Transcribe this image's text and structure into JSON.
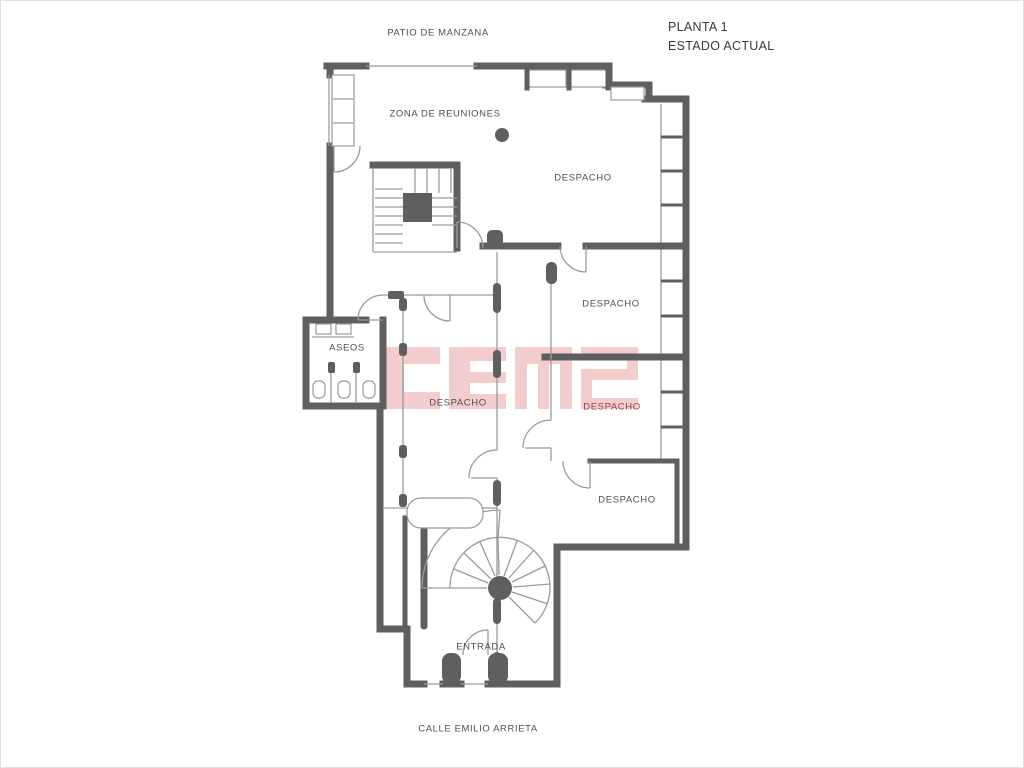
{
  "title": {
    "line1": "PLANTA 1",
    "line2": "ESTADO ACTUAL"
  },
  "context": {
    "top_street": "PATIO DE MANZANA",
    "bottom_street": "CALLE EMILIO ARRIETA"
  },
  "rooms": {
    "meeting": "ZONA DE REUNIONES",
    "office_top": "DESPACHO",
    "office_mid": "DESPACHO",
    "office_low": "DESPACHO",
    "office_center": "DESPACHO",
    "office_small": "DESPACHO",
    "toilets": "ASEOS",
    "entrance": "ENTRADA"
  },
  "watermark": {
    "text": "CEM2"
  },
  "colors": {
    "wall": "#5f5f5f",
    "thin_line": "#9a9a9a",
    "label": "#4f4f4f",
    "office_low_label": "#944040",
    "watermark": "#eba9a9"
  }
}
